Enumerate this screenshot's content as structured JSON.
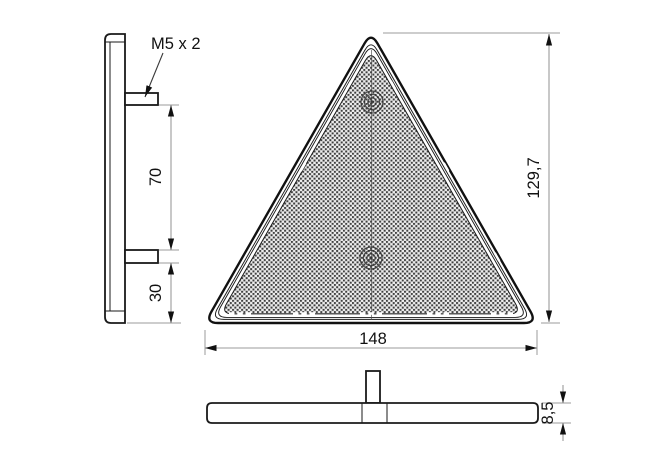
{
  "drawing": {
    "type": "technical-drawing",
    "subject": "triangular-reflector-with-mounting-studs",
    "labels": {
      "thread_callout": "M5 x 2",
      "stud_spacing": "70",
      "stud_base_offset": "30",
      "base_width": "148",
      "overall_height": "129,7",
      "thickness": "8,5"
    },
    "colors": {
      "background": "#ffffff",
      "object_line": "#1a1a1a",
      "dimension_line": "#9b9b9b",
      "text": "#111111",
      "reflector_texture_dark": "#3f3f3f",
      "reflector_texture_light": "#ededed"
    }
  }
}
